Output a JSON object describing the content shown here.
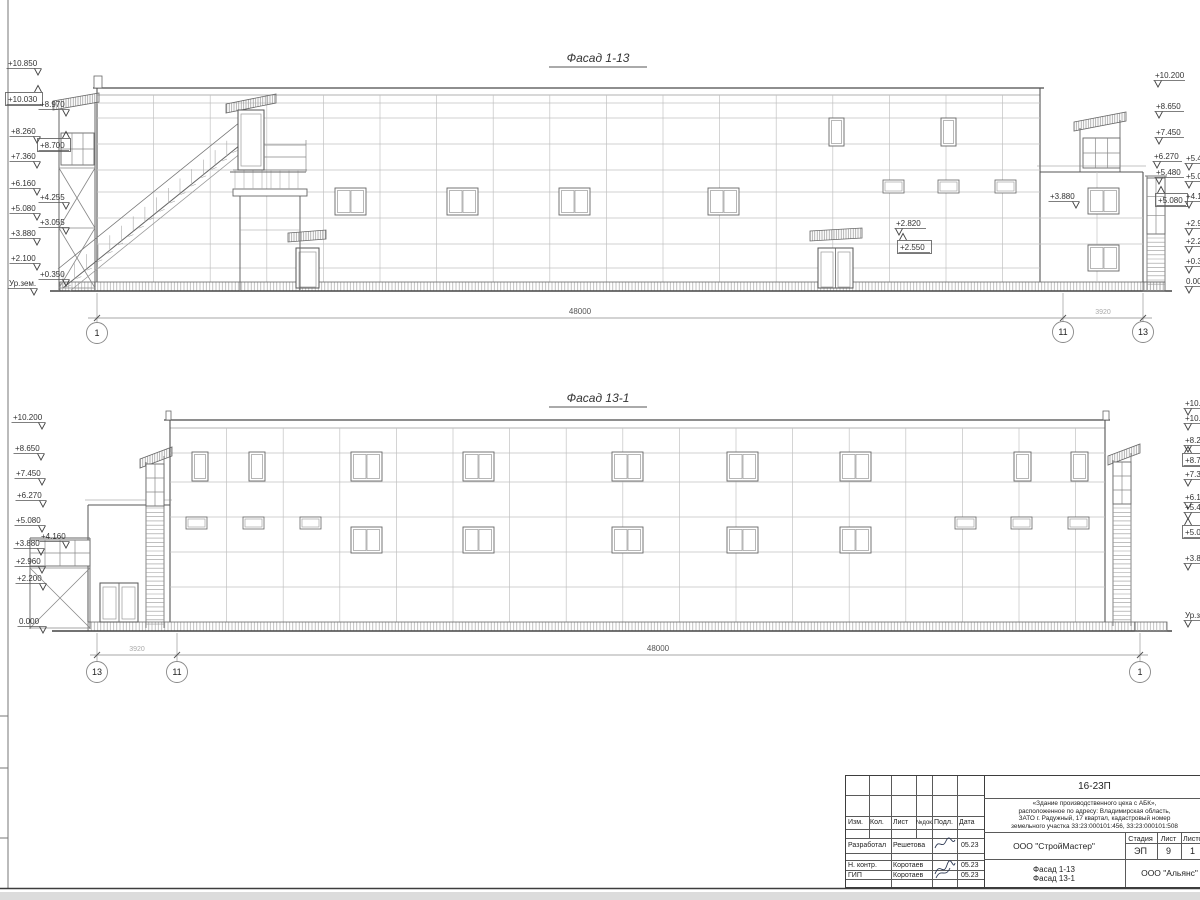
{
  "titles": {
    "top": "Фасад 1-13",
    "bottom": "Фасад 13-1"
  },
  "facade_top": {
    "marks": [
      "+10.850",
      "+10.030",
      "+8.970",
      "+8.260",
      "+8.700",
      "+7.360",
      "+6.160",
      "+5.080",
      "+4.255",
      "+3.880",
      "+3.055",
      "+2.100",
      "+0.350",
      "Ур.зем.",
      "+10.200",
      "+8.650",
      "+7.450",
      "+6.270",
      "+5.480",
      "+5.080",
      "+3.880",
      "+2.820",
      "+2.550",
      "+5.480",
      "+5.080",
      "+4.160",
      "+2.960",
      "+2.200",
      "+0.350",
      "0.000"
    ],
    "dim_48000": "48000",
    "dim_3920": "3920",
    "axes": [
      "1",
      "11",
      "13"
    ]
  },
  "facade_bottom": {
    "marks": [
      "+10.200",
      "+8.650",
      "+7.450",
      "+6.270",
      "+5.080",
      "+3.880",
      "+4.160",
      "+2.960",
      "+2.200",
      "0.000",
      "+10.850",
      "+10.030",
      "+8.260",
      "+8.700",
      "+7.360",
      "+6.160",
      "+5.480",
      "+5.080",
      "+3.880",
      "Ур.зем."
    ],
    "dim_48000": "48000",
    "dim_3920": "3920",
    "axes": [
      "13",
      "11",
      "1"
    ]
  },
  "title_block": {
    "doc_number": "16-23П",
    "project_lines": [
      "«Здание производственного цеха с АБК»,",
      "расположенное по адресу: Владимирская область,",
      "ЗАТО г. Радужный, 17 квартал, кадастровый номер",
      "земельного участка 33:23:000101:456, 33:23:000101:508"
    ],
    "designer_org": "ООО \"СтройМастер\"",
    "sheet_title_line1": "Фасад 1-13",
    "sheet_title_line2": "Фасад 13-1",
    "contractor_org": "ООО \"Альянс\"",
    "col_izm": "Изм.",
    "col_kol": "Кол.",
    "col_list": "Лист",
    "col_ndok": "№док.",
    "col_podl": "Подл.",
    "col_data": "Дата",
    "stage_label": "Стадия",
    "list_label": "Лист",
    "listov_label": "Листов",
    "stage_value": "ЭП",
    "list_value": "9",
    "listov_value": "1",
    "rows": [
      {
        "role": "Разработал",
        "name": "Решетова",
        "date": "05.23"
      },
      {
        "role": "Н. контр.",
        "name": "Коротаев",
        "date": "05.23"
      },
      {
        "role": "ГИП",
        "name": "Коротаев",
        "date": "05.23"
      }
    ]
  }
}
